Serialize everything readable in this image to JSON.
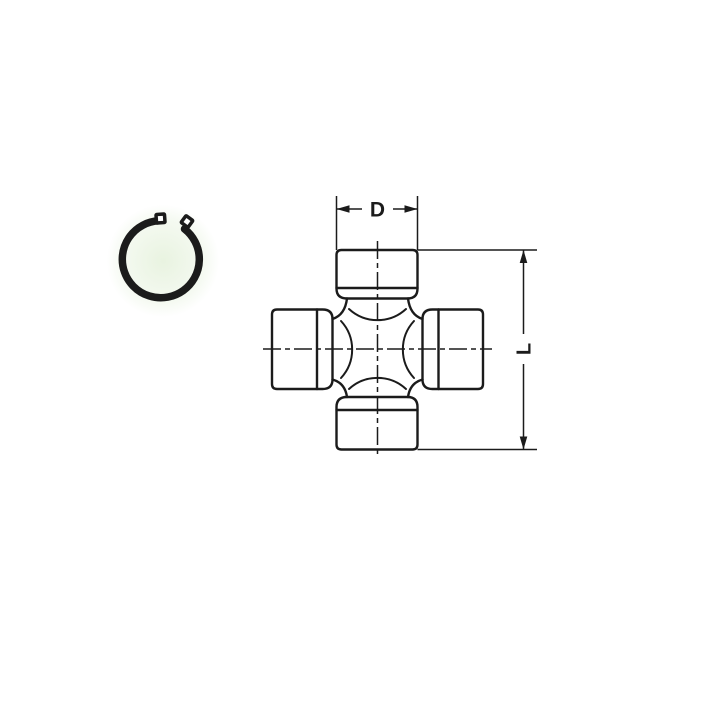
{
  "page": {
    "background_color": "#ffffff"
  },
  "diagram": {
    "kind": "technical-drawing",
    "line_color": "#1b1b1b",
    "halo_color": "#d6e9c7",
    "icons": {
      "snap_ring": "snap-ring-icon",
      "cross_joint": "universal-joint-cross-icon"
    },
    "dimensions": {
      "diameter_label": "D",
      "length_label": "L"
    }
  }
}
